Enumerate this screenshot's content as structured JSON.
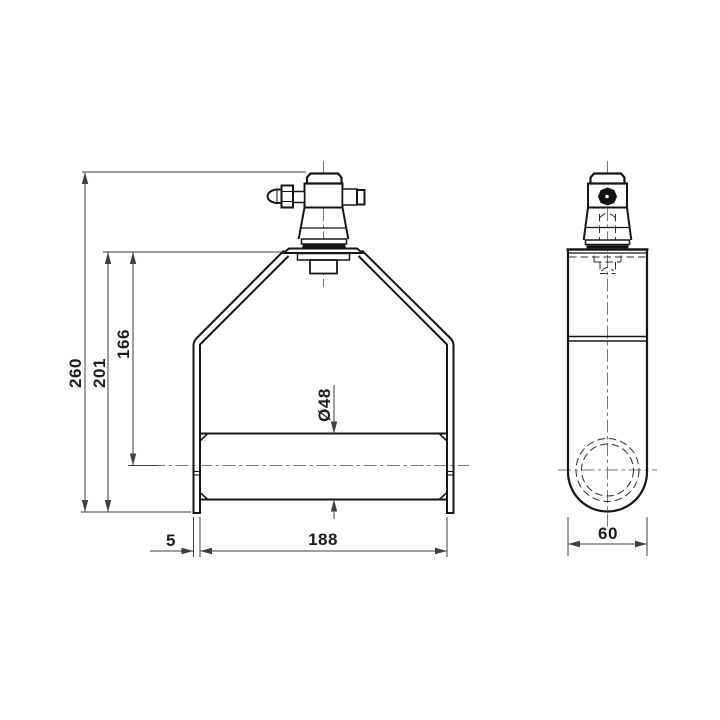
{
  "drawing": {
    "type": "technical-drawing",
    "description": "Two-view engineering drawing of a truss pipe clamp with conical coupler spigot and grease nipple",
    "views": [
      {
        "id": "front",
        "name": "front view"
      },
      {
        "id": "side",
        "name": "side view"
      }
    ],
    "colors": {
      "background": "#ffffff",
      "object_line": "#161616",
      "dimension_line": "#3f3f3f",
      "center_line": "#777777"
    },
    "dim_labels": {
      "overall_height": "260",
      "body_height": "201",
      "centerline_height": "166",
      "tube_diameter": "Ø48",
      "plate_thickness": "5",
      "inner_width": "188",
      "side_width": "60"
    }
  }
}
